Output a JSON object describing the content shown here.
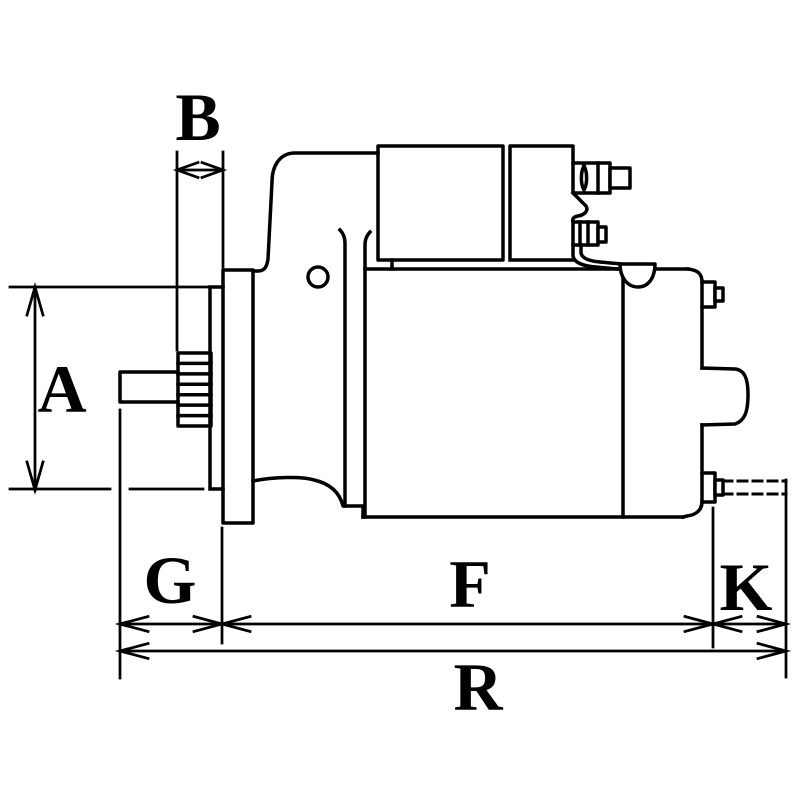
{
  "canvas": {
    "background_color": "#ffffff",
    "line_color": "#000000"
  },
  "labels": {
    "A": "A",
    "B": "B",
    "G": "G",
    "F": "F",
    "K": "K",
    "R": "R"
  }
}
